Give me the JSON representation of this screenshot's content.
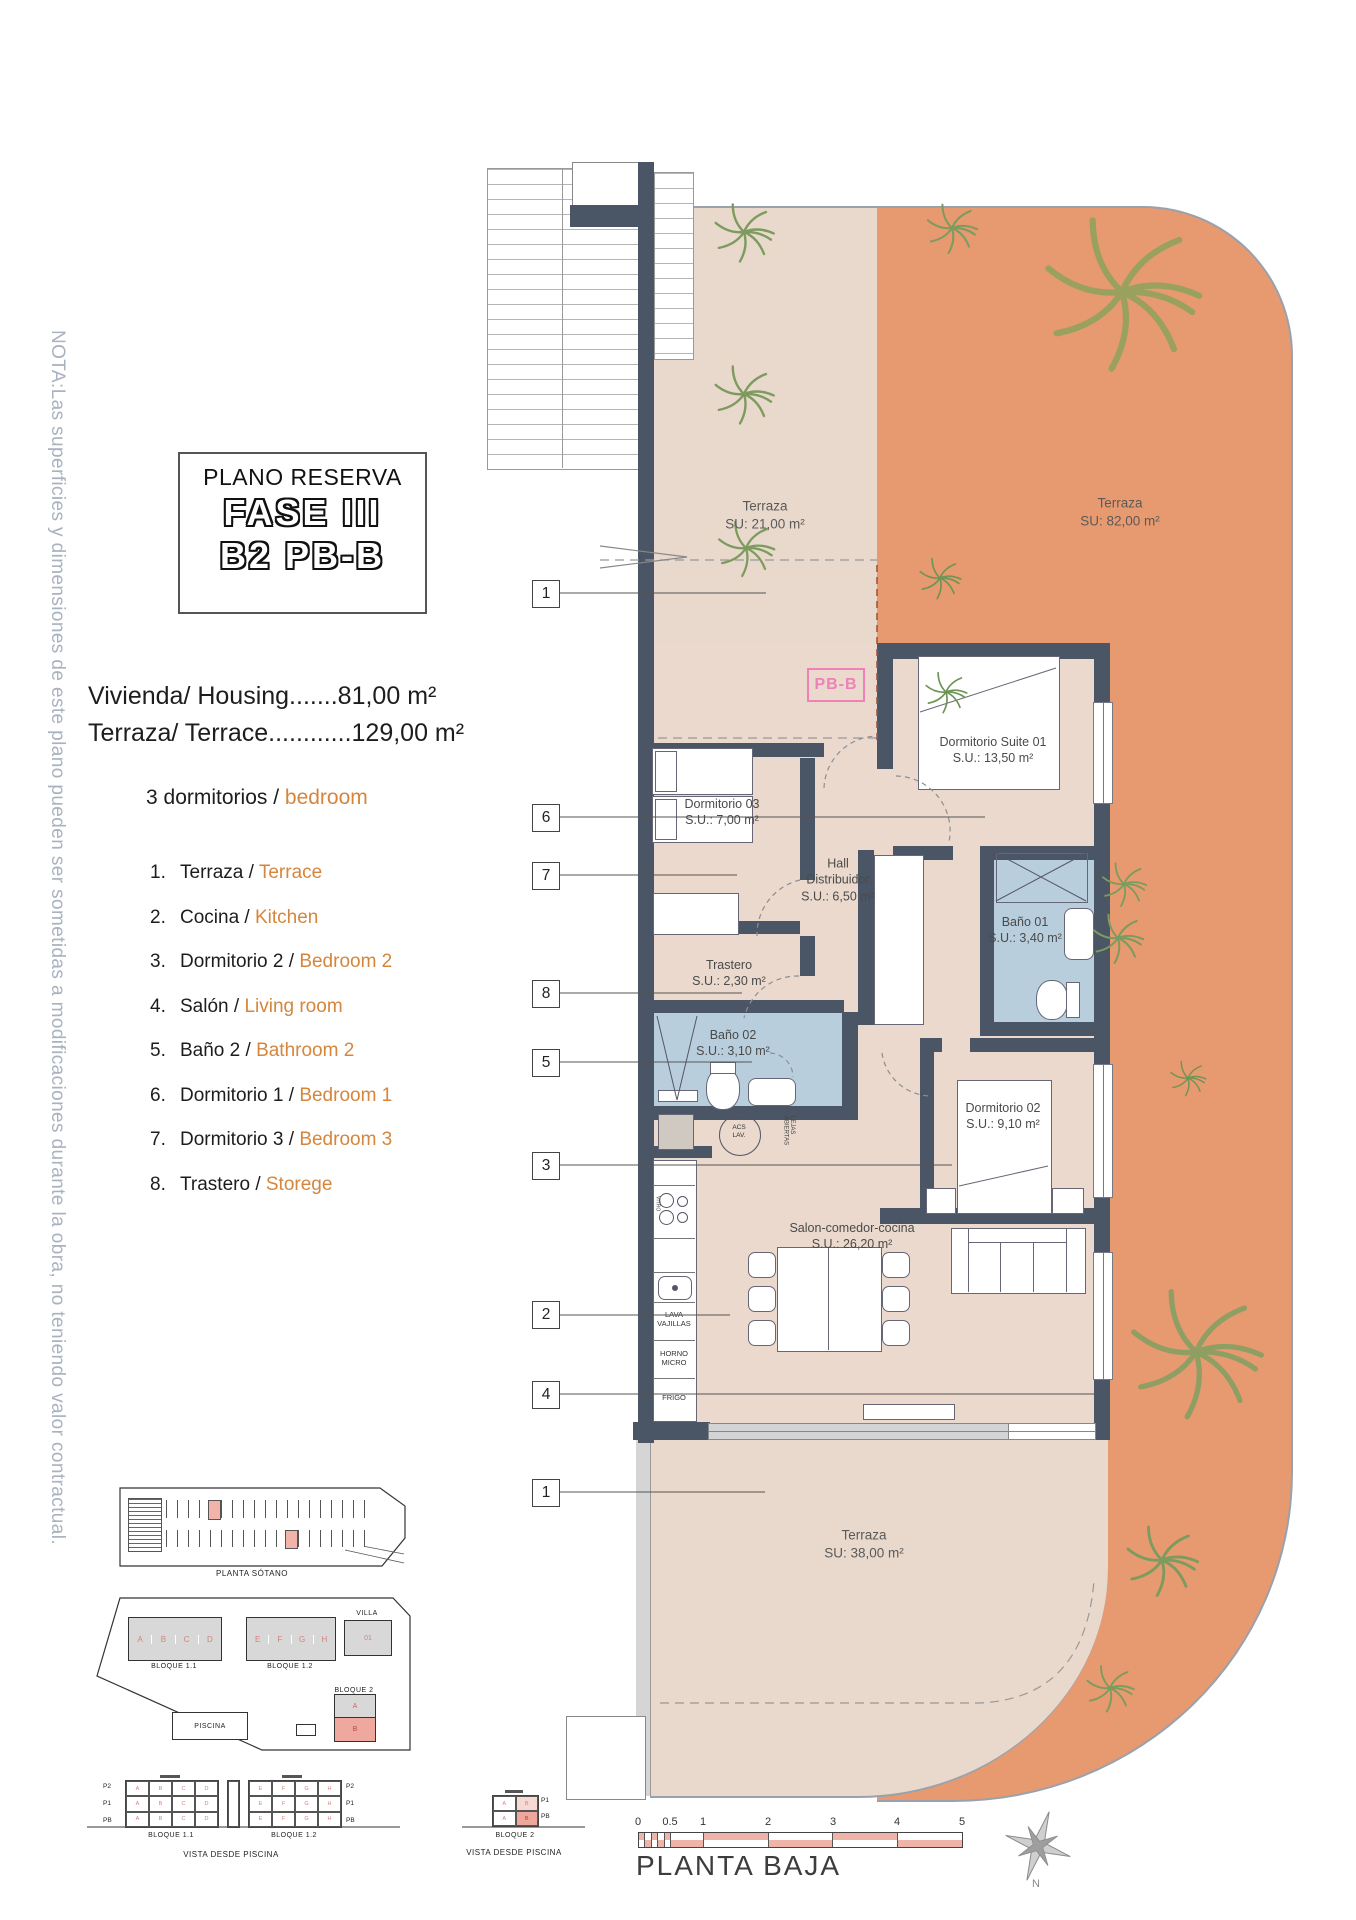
{
  "note": "NOTA:Las superficies y dimensiones de este plano pueden ser sometidas a modificaciones durante la obra, no teniendo valor contractual.",
  "title_block": {
    "line1": "PLANO RESERVA",
    "line2": "FASE III",
    "line3": "B2 PB-B"
  },
  "summary": {
    "housing": "Vivienda/ Housing.......81,00 m²",
    "terrace": "Terraza/ Terrace............129,00 m²",
    "bedrooms_prefix": "3 dormitorios / ",
    "bedrooms_en": "bedroom"
  },
  "legend": [
    {
      "num": "1.",
      "es": "Terraza / ",
      "en": "Terrace"
    },
    {
      "num": "2.",
      "es": "Cocina / ",
      "en": "Kitchen"
    },
    {
      "num": "3.",
      "es": "Dormitorio 2 / ",
      "en": "Bedroom 2"
    },
    {
      "num": "4.",
      "es": "Salón / ",
      "en": "Living room"
    },
    {
      "num": "5.",
      "es": "Baño 2 / ",
      "en": "Bathroom 2"
    },
    {
      "num": "6.",
      "es": "Dormitorio 1 / ",
      "en": "Bedroom 1"
    },
    {
      "num": "7.",
      "es": "Dormitorio 3 / ",
      "en": "Bedroom 3"
    },
    {
      "num": "8.",
      "es": "Trastero / ",
      "en": "Storege"
    }
  ],
  "plan": {
    "unit_label": "PB-B",
    "rooms": [
      {
        "name": "Terraza",
        "area": "SU: 21,00 m²"
      },
      {
        "name": "Terraza",
        "area": "SU: 82,00 m²"
      },
      {
        "name": "Dormitorio Suite 01",
        "area": "S.U.: 13,50 m²"
      },
      {
        "name": "Dormitorio 03",
        "area": "S.U.: 7,00 m²"
      },
      {
        "name": "Hall\nDistribuidor",
        "area": "S.U.: 6,50 m²"
      },
      {
        "name": "Baño 01",
        "area": "S.U.: 3,40 m²"
      },
      {
        "name": "Trastero",
        "area": "S.U.: 2,30 m²"
      },
      {
        "name": "Baño 02",
        "area": "S.U.: 3,10 m²"
      },
      {
        "name": "Dormitorio 02",
        "area": "S.U.: 9,10 m²"
      },
      {
        "name": "Salon-comedor-cocina",
        "area": "S.U.: 26,20 m²"
      },
      {
        "name": "Terraza",
        "area": "SU: 38,00 m²"
      }
    ],
    "callouts": [
      "1",
      "6",
      "7",
      "8",
      "5",
      "3",
      "2",
      "4",
      "1"
    ],
    "kitchen_labels": [
      "LAVA\nVAJILLAS",
      "HORNO\nMICRO",
      "FRIGO"
    ],
    "appliances": {
      "washer": "ACS\nLAV.",
      "shelves": "LEJAS\nABIERTAS",
      "hob": "VITRO"
    }
  },
  "site": {
    "sotano_caption": "PLANTA SÓTANO",
    "bloque11": "BLOQUE 1.1",
    "bloque12": "BLOQUE 1.2",
    "bloque2": "BLOQUE 2",
    "villa": "VILLA",
    "villa_unit": "01",
    "piscina": "PISCINA",
    "letters1": [
      "A",
      "B",
      "C",
      "D"
    ],
    "letters2": [
      "E",
      "F",
      "G",
      "H"
    ],
    "bloque2_units": [
      "A",
      "B"
    ]
  },
  "elevations": {
    "rows": [
      "P2",
      "P1",
      "PB"
    ],
    "rows2": [
      "P1",
      "PB"
    ],
    "caption1": "BLOQUE 1.1",
    "caption2": "BLOQUE 1.2",
    "caption3": "BLOQUE 2",
    "view": "VISTA DESDE PISCINA"
  },
  "scalebar": {
    "ticks": [
      "0",
      "0.5",
      "1",
      "2",
      "3",
      "4",
      "5"
    ],
    "caption": "PLANTA BAJA"
  },
  "compass": {
    "north": "N"
  },
  "colors": {
    "orange_terrace": "#e79a6f",
    "floor_beige": "#e8d9cc",
    "wall": "#4a5565",
    "bath_blue": "#b9cedd",
    "accent_orange": "#d5863c",
    "unit_pink": "#ee82b6",
    "legend_pink": "#d4837c",
    "note_gray": "#a9b2bf"
  }
}
